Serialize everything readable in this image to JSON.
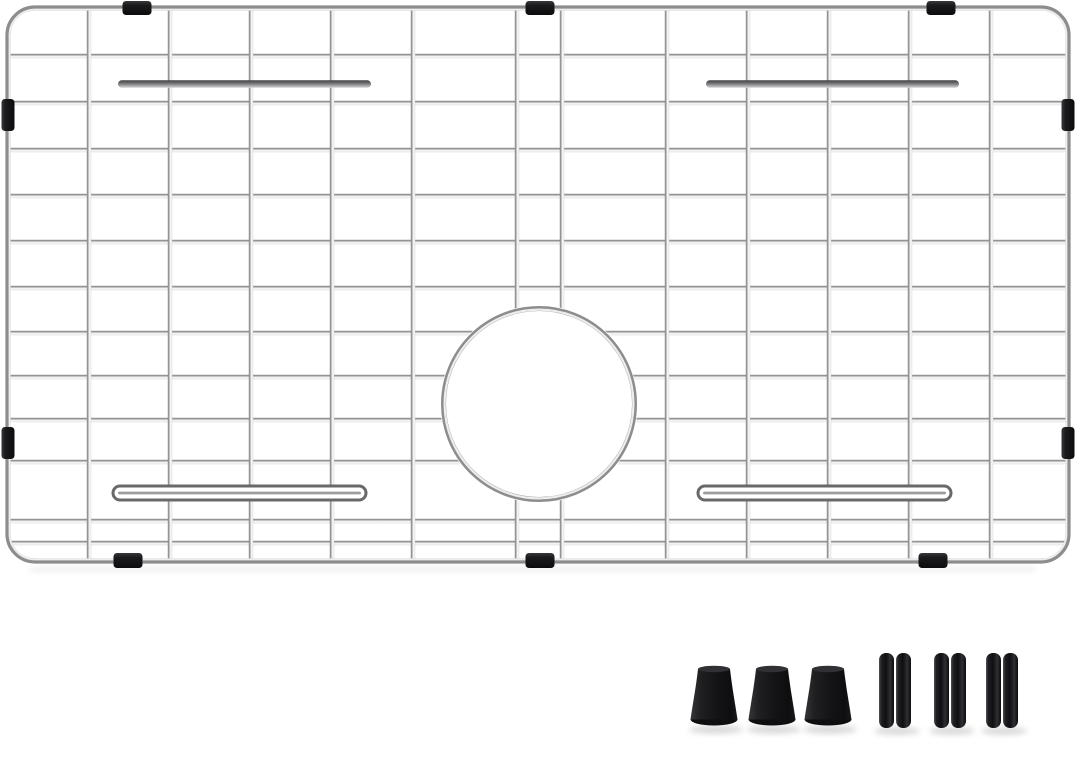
{
  "meta": {
    "subject": "stainless-steel sink bottom grid with rear drain hole, black rubber edge bumpers and spare rubber feet",
    "background_color": "#ffffff"
  },
  "palette": {
    "bg": "#ffffff",
    "wire_dark": "#7c7c7c",
    "wire_mid": "#a8a8a8",
    "wire_light": "#f3f3f3",
    "wire_edge": "#cfcfcf",
    "frame_stroke": "#8d8d8d",
    "frame_highlight": "#ededed",
    "rubber_dark": "#0c0c0e",
    "rubber_mid": "#1b1b1e",
    "rubber_light": "#38383c",
    "clip_sheen": "#505055",
    "bar_dark": "#3f3f42",
    "bar_mid": "#77777a",
    "bar_light": "#d4d4d6",
    "shadow": "#d4d4d4",
    "frame_shadow": "#e8e8e8"
  },
  "grid": {
    "frame": {
      "x": 8,
      "y": 8,
      "width": 1060,
      "height": 553,
      "corner_radius": 27,
      "stroke_width": 5.2
    },
    "wire_width": 4.4,
    "vertical_lines_x": [
      89,
      170,
      251,
      332,
      413,
      517,
      562,
      667,
      748,
      829,
      910,
      991
    ],
    "horizontal_lines_y": [
      56,
      103,
      150,
      196,
      242,
      288,
      333,
      377,
      420,
      462,
      521,
      543
    ]
  },
  "drain_hole": {
    "cx": 539,
    "cy": 404,
    "radius": 95.5
  },
  "edge_bumpers": {
    "top_centers_x": [
      137,
      540,
      941
    ],
    "bottom_centers_x": [
      128,
      540,
      933
    ],
    "left_centers_y": [
      115,
      443
    ],
    "right_centers_y": [
      115,
      443
    ],
    "horizontal_size": {
      "w": 29,
      "h": 14
    },
    "vertical_size": {
      "w": 13,
      "h": 32
    }
  },
  "feet_bars": [
    {
      "x1": 118,
      "x2": 371,
      "cy": 84,
      "style": "solid"
    },
    {
      "x1": 706,
      "x2": 959,
      "cy": 84,
      "style": "solid"
    },
    {
      "x1": 113,
      "x2": 366,
      "cy": 493,
      "style": "outline"
    },
    {
      "x1": 698,
      "x2": 951,
      "cy": 493,
      "style": "outline"
    }
  ],
  "accessories": {
    "cone_feet": {
      "centers_x": [
        714,
        772,
        828
      ],
      "top_y": 669,
      "base_y": 719.5,
      "top_half_width": 16,
      "base_half_width": 23.5
    },
    "clip_feet": {
      "centers_x": [
        895,
        950,
        1002
      ],
      "top_y": 653,
      "height": 75,
      "bar_width": 15,
      "gap": 2
    },
    "shadow_y": 729.5
  }
}
